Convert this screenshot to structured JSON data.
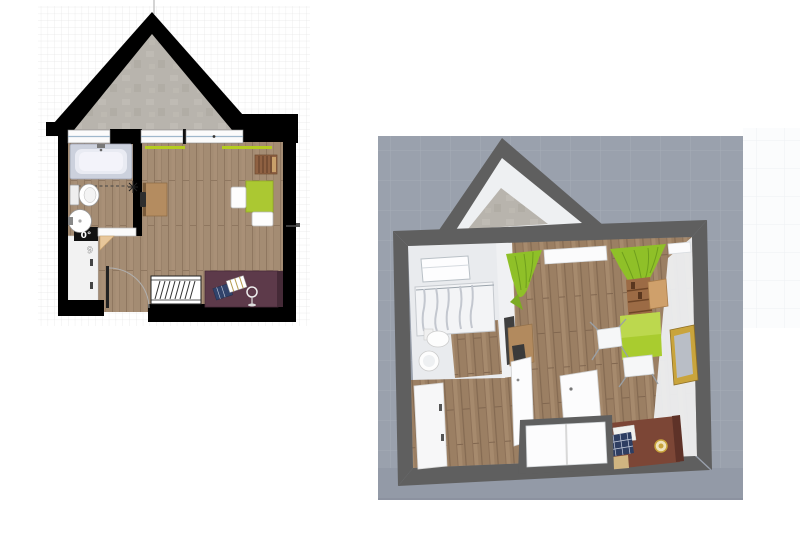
{
  "app": {
    "description": "Home design editor canvas showing the same attic studio as a 2D floor plan and a 3D aerial view",
    "background": "#ffffff"
  },
  "plan2d": {
    "label": "2D floor plan (top view)",
    "selected_door": {
      "angle_label": "0°",
      "size_label": "9"
    },
    "colors": {
      "grid": "#e6e6e6",
      "wall": "#000000",
      "concrete": "#b8b4ad",
      "wood": "#a48c73",
      "window_glass": "#9fb8cc",
      "curtain": "#b5cc20",
      "desk": "#b48c60",
      "desk_chair": "#2e2e2e",
      "shelf": "#8f6142",
      "table_green": "#abc832",
      "bed": "#5d3a4a",
      "headboard": "#452a37",
      "door_swing": "#e8c79a",
      "corridor": "#f2f2f2",
      "radiator": "#ffffff"
    },
    "rooms": [
      "bathroom",
      "main-room",
      "corridor"
    ],
    "furniture": [
      "bathtub",
      "toilet",
      "sink",
      "bathroom-door",
      "entry-door",
      "desk",
      "desk-chair",
      "radiator",
      "wall-shelf",
      "green-table",
      "white-chair",
      "white-chair",
      "bed",
      "pillows",
      "floor-lamp"
    ]
  },
  "view3d": {
    "label": "3D aerial view",
    "colors": {
      "ground": "#9aa1ad",
      "ground_grid": "#a6adb8",
      "slab": "#939aa7",
      "wall": "#5f5f5f",
      "gable_inner": "#eef0f2",
      "concrete": "#b8b4ad",
      "wood": "#9b7f63",
      "bath_floor": "#e9ebee",
      "curtain": "#8fc028",
      "bed": "#7c4636",
      "headboard": "#5e3228",
      "mirror_frame": "#c9a43c",
      "table_green": "#a9cc2f",
      "shelf": "#9c6b45"
    },
    "furniture": [
      "bathroom-window",
      "bathtub-shower",
      "toilet",
      "sink",
      "cabinet",
      "green-curtains",
      "wall-shelf",
      "side-desk",
      "green-desk",
      "white-chair",
      "white-chair",
      "gold-mirror",
      "open-door",
      "open-door",
      "bed",
      "pillows",
      "gold-lamp",
      "bottom-window"
    ]
  }
}
